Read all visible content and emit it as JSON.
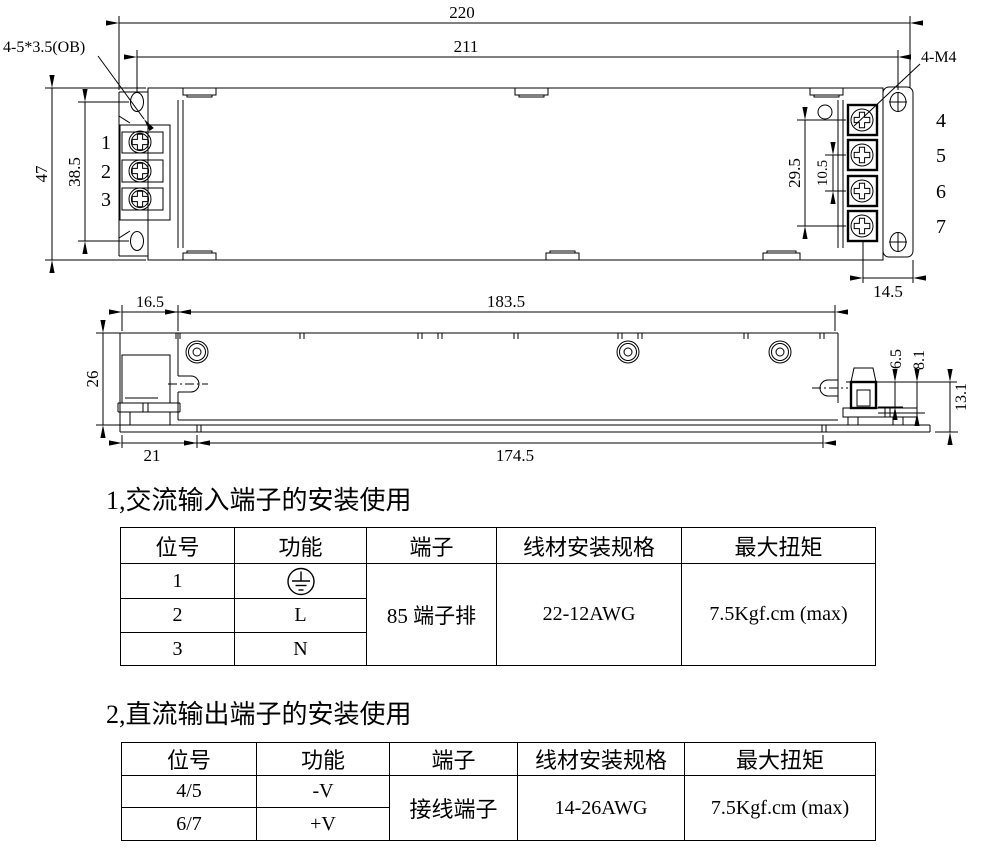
{
  "drawing": {
    "top": {
      "dim_width_outer": "220",
      "dim_width_inner": "211",
      "dim_height_outer": "47",
      "dim_height_inner": "38.5",
      "dim_right_terminal_span": "29.5",
      "dim_right_terminal_pitch": "10.5",
      "dim_right_offset": "14.5",
      "label_mounting_holes": "4-5*3.5(OB)",
      "label_screws": "4-M4",
      "left_terminals": [
        "1",
        "2",
        "3"
      ],
      "right_terminals": [
        "4",
        "5",
        "6",
        "7"
      ]
    },
    "side": {
      "dim_left_offset": "16.5",
      "dim_body_length": "183.5",
      "dim_height": "26",
      "dim_foot_offset": "21",
      "dim_foot_span": "174.5",
      "dim_tab_a": "6.5",
      "dim_tab_b": "8.1",
      "dim_tab_c": "13.1"
    }
  },
  "sections": [
    {
      "heading": "1,交流输入端子的安装使用",
      "headers": [
        "位号",
        "功能",
        "端子",
        "线材安装规格",
        "最大扭矩"
      ],
      "rows": [
        {
          "pos": "1",
          "func": "",
          "function_symbol": "protective-earth"
        },
        {
          "pos": "2",
          "func": "L"
        },
        {
          "pos": "3",
          "func": "N"
        }
      ],
      "terminal": "85 端子排",
      "wire": "22-12AWG",
      "torque": "7.5Kgf.cm (max)"
    },
    {
      "heading": "2,直流输出端子的安装使用",
      "headers": [
        "位号",
        "功能",
        "端子",
        "线材安装规格",
        "最大扭矩"
      ],
      "rows": [
        {
          "pos": "4/5",
          "func": "-V"
        },
        {
          "pos": "6/7",
          "func": "+V"
        }
      ],
      "terminal": "接线端子",
      "wire": "14-26AWG",
      "torque": "7.5Kgf.cm (max)"
    }
  ]
}
